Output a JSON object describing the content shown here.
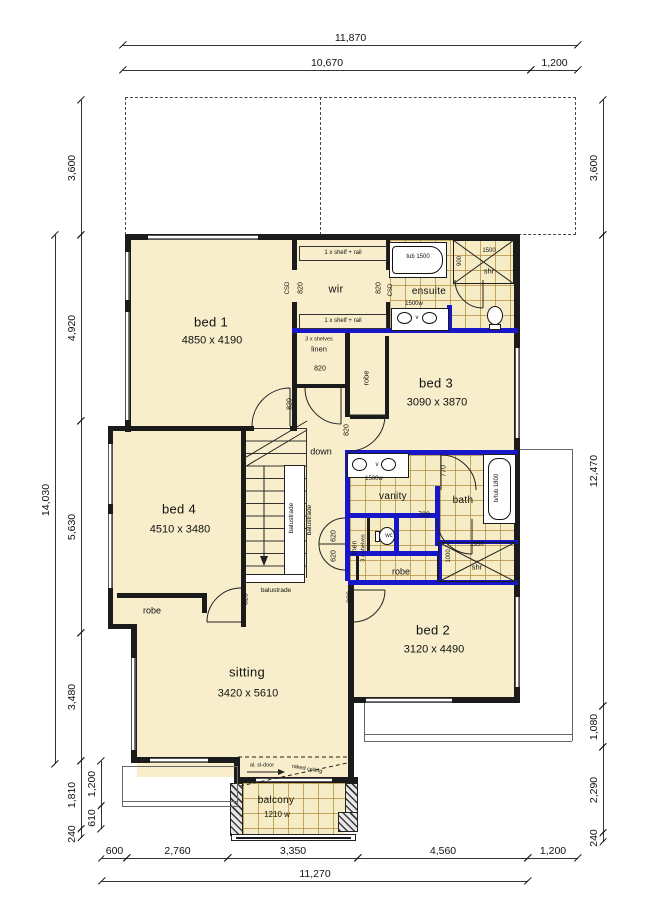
{
  "colors": {
    "wall": "#1b1b1b",
    "wet_area_wall": "#1717c9",
    "room_fill": "#f8eecb",
    "tile_line": "#b08d3c",
    "dimension_text": "#111111",
    "window_line": "#777777"
  },
  "rooms": [
    {
      "name": "bed 1",
      "size": "4850 x 4190",
      "x": 211,
      "y": 322,
      "dy": 19
    },
    {
      "name": "wir",
      "x": 336,
      "y": 290,
      "ns": 11
    },
    {
      "name": "ensuite",
      "x": 429,
      "y": 292,
      "ns": 10
    },
    {
      "name": "bed 3",
      "size": "3090 x 3870",
      "x": 436,
      "y": 383,
      "dy": 20
    },
    {
      "name": "bed 4",
      "size": "4510 x 3480",
      "x": 179,
      "y": 509,
      "dy": 21
    },
    {
      "name": "vanity",
      "x": 393,
      "y": 497,
      "ns": 10
    },
    {
      "name": "bath",
      "x": 463,
      "y": 501,
      "ns": 10
    },
    {
      "name": "bed 2",
      "size": "3120 x 4490",
      "x": 433,
      "y": 630,
      "dy": 20
    },
    {
      "name": "sitting",
      "size": "3420 x 5610",
      "x": 247,
      "y": 672,
      "dy": 22
    },
    {
      "name": "balcony",
      "size": "1210 w",
      "x": 276,
      "y": 801,
      "ns": 10,
      "dy": 14,
      "ss": 8
    }
  ],
  "labels": [
    {
      "t": "down",
      "x": 321,
      "y": 452,
      "s": 9,
      "n": "down-label"
    },
    {
      "t": "1 x shelf + rail",
      "x": 343,
      "y": 253,
      "s": 6,
      "n": "wir-shelf-rail-top"
    },
    {
      "t": "1 x shelf + rail",
      "x": 343,
      "y": 321,
      "s": 6,
      "n": "wir-shelf-rail-bottom"
    },
    {
      "t": "CSD",
      "x": 288,
      "y": 288,
      "s": 6,
      "r": -90,
      "n": "csd-bed1-side"
    },
    {
      "t": "CSD",
      "x": 391,
      "y": 290,
      "s": 6,
      "r": -90,
      "n": "csd-ensuite-side"
    },
    {
      "t": "820",
      "x": 301,
      "y": 288,
      "s": 7,
      "r": -90,
      "n": "wir-opening-left-820"
    },
    {
      "t": "820",
      "x": 379,
      "y": 288,
      "s": 7,
      "r": -90,
      "n": "wir-opening-right-820"
    },
    {
      "t": "3 x shelves",
      "x": 319,
      "y": 340,
      "s": 5.5,
      "n": "linen-shelves-note"
    },
    {
      "t": "linen",
      "x": 319,
      "y": 349,
      "s": 7.5,
      "n": "linen-label"
    },
    {
      "t": "820",
      "x": 320,
      "y": 369,
      "s": 7,
      "n": "linen-door-820"
    },
    {
      "t": "robe",
      "x": 366,
      "y": 378,
      "s": 7.5,
      "r": -90,
      "n": "bed3-robe-label"
    },
    {
      "t": "820",
      "x": 290,
      "y": 404,
      "s": 7,
      "r": -90,
      "n": "bed1-door-820"
    },
    {
      "t": "820",
      "x": 347,
      "y": 430,
      "s": 7,
      "r": -90,
      "n": "bed3-door-820"
    },
    {
      "t": "tub 1500",
      "x": 418,
      "y": 257,
      "s": 6,
      "n": "ensuite-tub-label"
    },
    {
      "t": "1500",
      "x": 489,
      "y": 251,
      "s": 6,
      "n": "ensuite-shower-1500"
    },
    {
      "t": "900",
      "x": 460,
      "y": 261,
      "s": 6,
      "r": -90,
      "n": "ensuite-shower-900"
    },
    {
      "t": "shr",
      "x": 489,
      "y": 271,
      "s": 7.5,
      "n": "ensuite-shower-label"
    },
    {
      "t": "1500w",
      "x": 414,
      "y": 304,
      "s": 6,
      "n": "ensuite-vanity-1500w"
    },
    {
      "t": "v",
      "x": 417,
      "y": 318,
      "s": 6,
      "n": "ensuite-vanity-v"
    },
    {
      "t": "balustrade",
      "x": 292,
      "y": 518,
      "s": 6.5,
      "r": -90,
      "n": "balustrade-inner"
    },
    {
      "t": "balustrade",
      "x": 310,
      "y": 520,
      "s": 6.5,
      "r": -90,
      "n": "balustrade-outer"
    },
    {
      "t": "balustrade",
      "x": 276,
      "y": 591,
      "s": 6.5,
      "n": "balustrade-bottom"
    },
    {
      "t": "v",
      "x": 377,
      "y": 465,
      "s": 6,
      "n": "vanity-v"
    },
    {
      "t": "1500w",
      "x": 374,
      "y": 479,
      "s": 6,
      "n": "vanity-1500w"
    },
    {
      "t": "770",
      "x": 444,
      "y": 471,
      "s": 7,
      "r": -90,
      "n": "bath-door-770"
    },
    {
      "t": "720",
      "x": 424,
      "y": 515,
      "s": 7,
      "n": "vanity-door-720"
    },
    {
      "t": "b/tub 1800",
      "x": 497,
      "y": 488,
      "s": 6,
      "r": -90,
      "n": "bath-tub-label"
    },
    {
      "t": "wc",
      "x": 389,
      "y": 536,
      "s": 6,
      "n": "wc-label"
    },
    {
      "t": "linen",
      "x": 355,
      "y": 548,
      "s": 7,
      "r": -90,
      "n": "linen2-label"
    },
    {
      "t": "3 x shelves",
      "x": 364,
      "y": 548,
      "s": 5.5,
      "r": -90,
      "n": "linen2-shelves-note"
    },
    {
      "t": "620",
      "x": 334,
      "y": 536,
      "s": 7,
      "r": -90,
      "n": "door-620-upper"
    },
    {
      "t": "620",
      "x": 334,
      "y": 556,
      "s": 7,
      "r": -90,
      "n": "door-620-lower"
    },
    {
      "t": "1950",
      "x": 477,
      "y": 545,
      "s": 6,
      "n": "shower-1950"
    },
    {
      "t": "1000",
      "x": 449,
      "y": 556,
      "s": 6,
      "r": -90,
      "n": "shower-1000"
    },
    {
      "t": "shr",
      "x": 477,
      "y": 567,
      "s": 7.5,
      "n": "shower-label"
    },
    {
      "t": "robe",
      "x": 401,
      "y": 572,
      "s": 9,
      "n": "bed2-robe-label"
    },
    {
      "t": "820",
      "x": 350,
      "y": 597,
      "s": 7,
      "r": -90,
      "n": "bed2-door-820"
    },
    {
      "t": "820",
      "x": 246,
      "y": 599,
      "s": 7,
      "r": -90,
      "n": "bed4-door-820"
    },
    {
      "t": "robe",
      "x": 152,
      "y": 611,
      "s": 9,
      "n": "bed4-robe-label"
    },
    {
      "t": "al. sl-door",
      "x": 262,
      "y": 766,
      "s": 5.5,
      "n": "sliding-door-note"
    },
    {
      "t": "raked ceiling",
      "x": 307,
      "y": 770,
      "s": 5.5,
      "r": 10,
      "n": "raked-ceiling-note"
    }
  ],
  "dimensions": {
    "horizontal": [
      {
        "t": "11,870",
        "x1": 123,
        "x2": 578,
        "y": 45
      },
      {
        "t": "10,670",
        "x1": 123,
        "x2": 531,
        "y": 70
      },
      {
        "t": "1,200",
        "x1": 531,
        "x2": 578,
        "y": 70
      },
      {
        "t": "600",
        "x1": 102,
        "x2": 127,
        "y": 858
      },
      {
        "t": "2,760",
        "x1": 127,
        "x2": 228,
        "y": 858
      },
      {
        "t": "3,350",
        "x1": 228,
        "x2": 358,
        "y": 858
      },
      {
        "t": "4,560",
        "x1": 358,
        "x2": 528,
        "y": 858
      },
      {
        "t": "1,200",
        "x1": 528,
        "x2": 578,
        "y": 858
      },
      {
        "t": "11,270",
        "x1": 102,
        "x2": 528,
        "y": 881
      }
    ],
    "vertical": [
      {
        "t": "3,600",
        "x": 81,
        "y1": 100,
        "y2": 235
      },
      {
        "t": "4,920",
        "x": 81,
        "y1": 235,
        "y2": 421
      },
      {
        "t": "5,630",
        "x": 81,
        "y1": 421,
        "y2": 633
      },
      {
        "t": "3,480",
        "x": 81,
        "y1": 633,
        "y2": 761
      },
      {
        "t": "1,810",
        "x": 81,
        "y1": 761,
        "y2": 829
      },
      {
        "t": "240",
        "x": 81,
        "y1": 829,
        "y2": 838
      },
      {
        "t": "14,030",
        "x": 55,
        "y1": 235,
        "y2": 764
      },
      {
        "t": "1,200",
        "x": 101,
        "y1": 761,
        "y2": 806
      },
      {
        "t": "610",
        "x": 101,
        "y1": 806,
        "y2": 829
      },
      {
        "t": "3,600",
        "x": 603,
        "y1": 100,
        "y2": 235
      },
      {
        "t": "12,470",
        "x": 603,
        "y1": 235,
        "y2": 706
      },
      {
        "t": "1,080",
        "x": 603,
        "y1": 706,
        "y2": 747
      },
      {
        "t": "2,290",
        "x": 603,
        "y1": 747,
        "y2": 833
      },
      {
        "t": "240",
        "x": 603,
        "y1": 833,
        "y2": 842
      }
    ]
  }
}
